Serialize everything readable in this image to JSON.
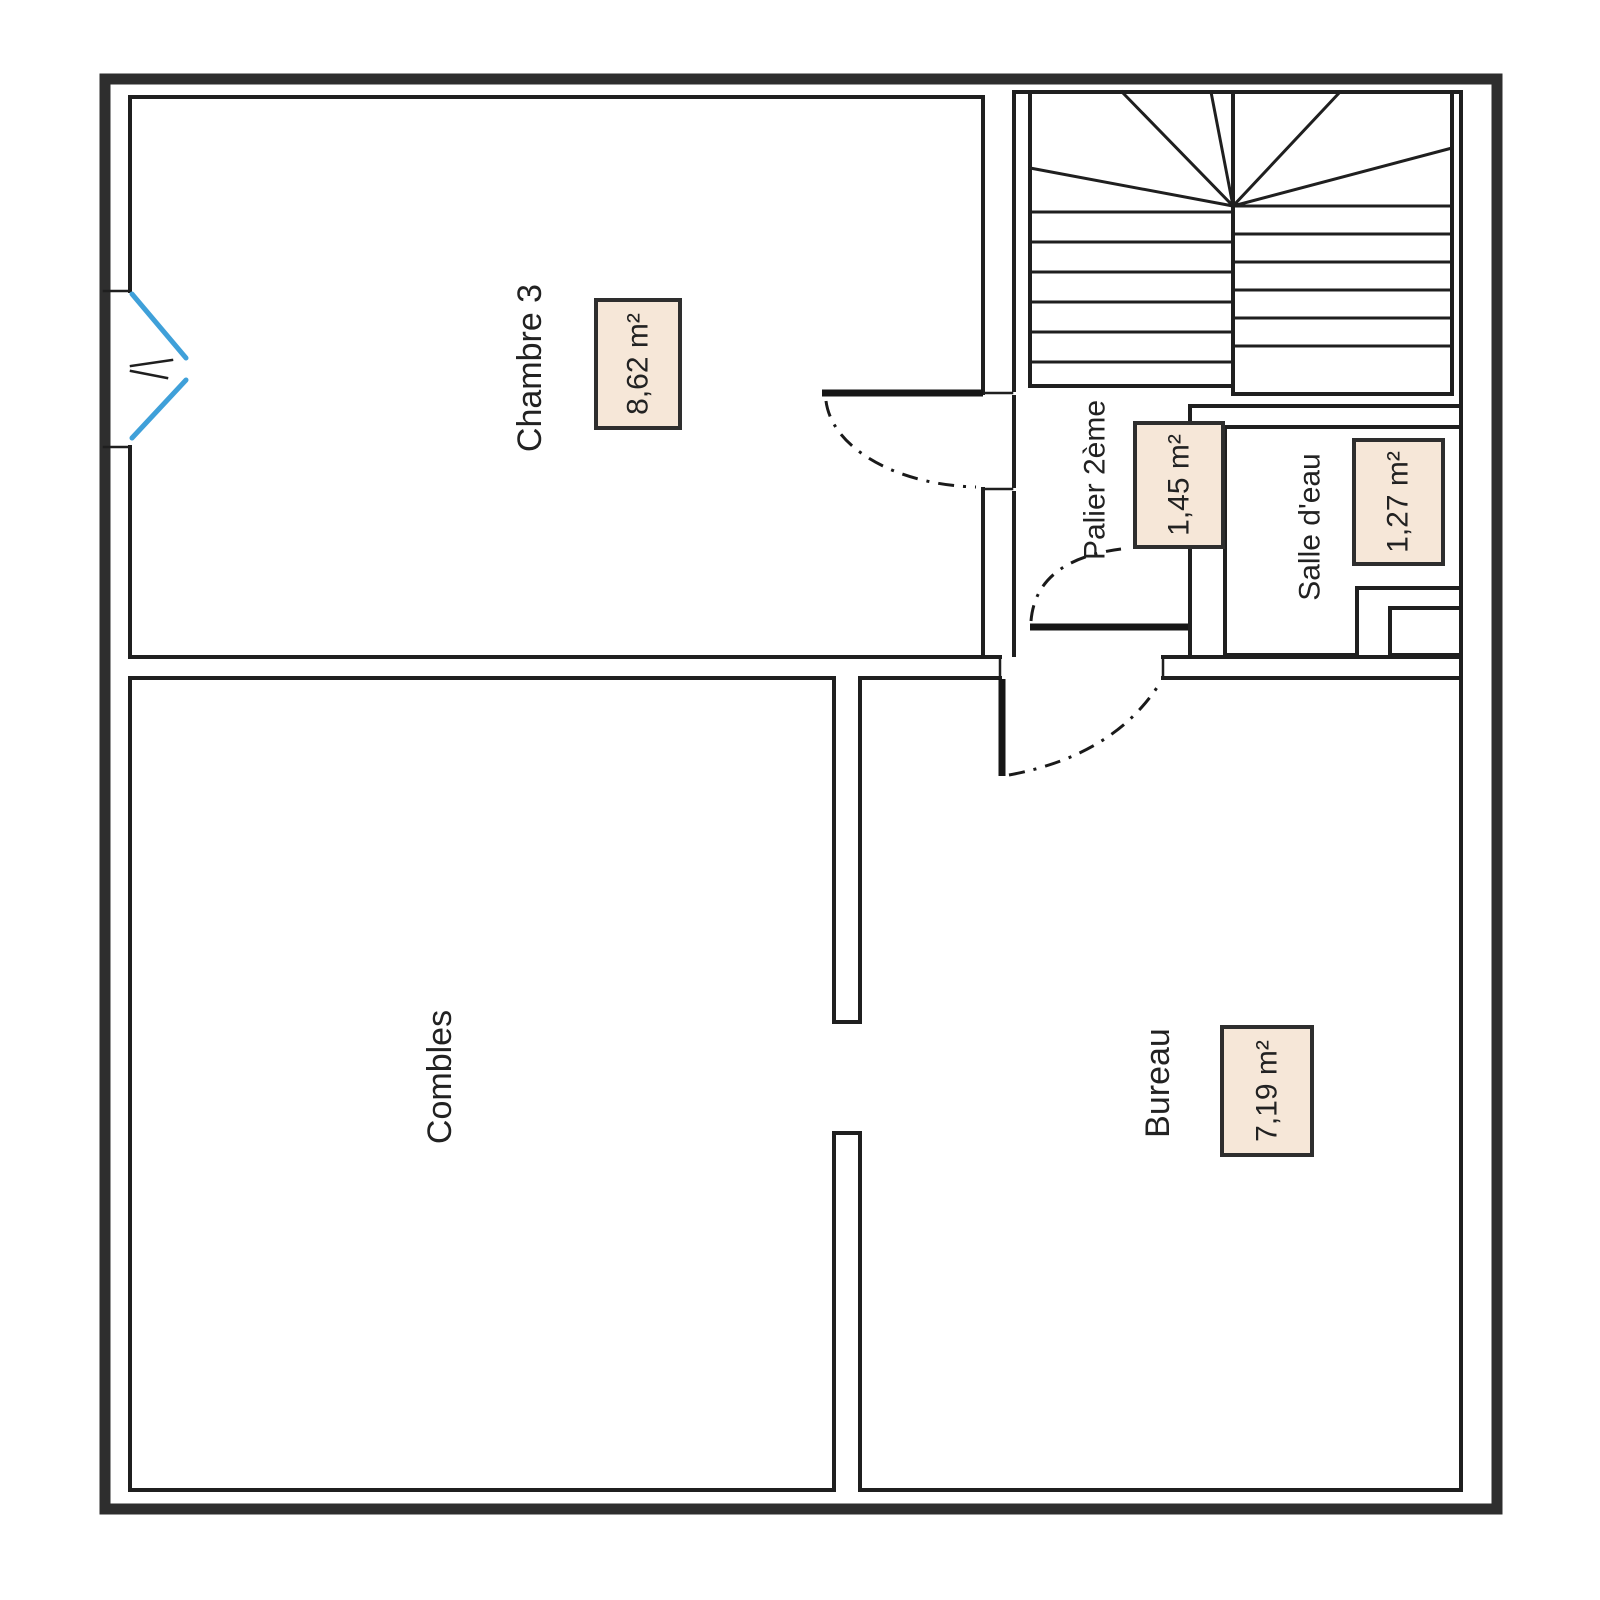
{
  "rooms": {
    "chambre3": {
      "name": "Chambre 3",
      "area": "8,62 m²"
    },
    "palier": {
      "name": "Palier 2ème",
      "area": "1,45 m²"
    },
    "salle_eau": {
      "name": "Salle d'eau",
      "area": "1,27 m²"
    },
    "combles": {
      "name": "Combles"
    },
    "bureau": {
      "name": "Bureau",
      "area": "7,19 m²"
    }
  },
  "colors": {
    "wall": "#2e2e2e",
    "line": "#1f1f1f",
    "window": "#3fa0d9",
    "box_fill": "#f6e7d8",
    "box_border": "#2e2e2e",
    "text": "#222222",
    "background": "#ffffff"
  }
}
